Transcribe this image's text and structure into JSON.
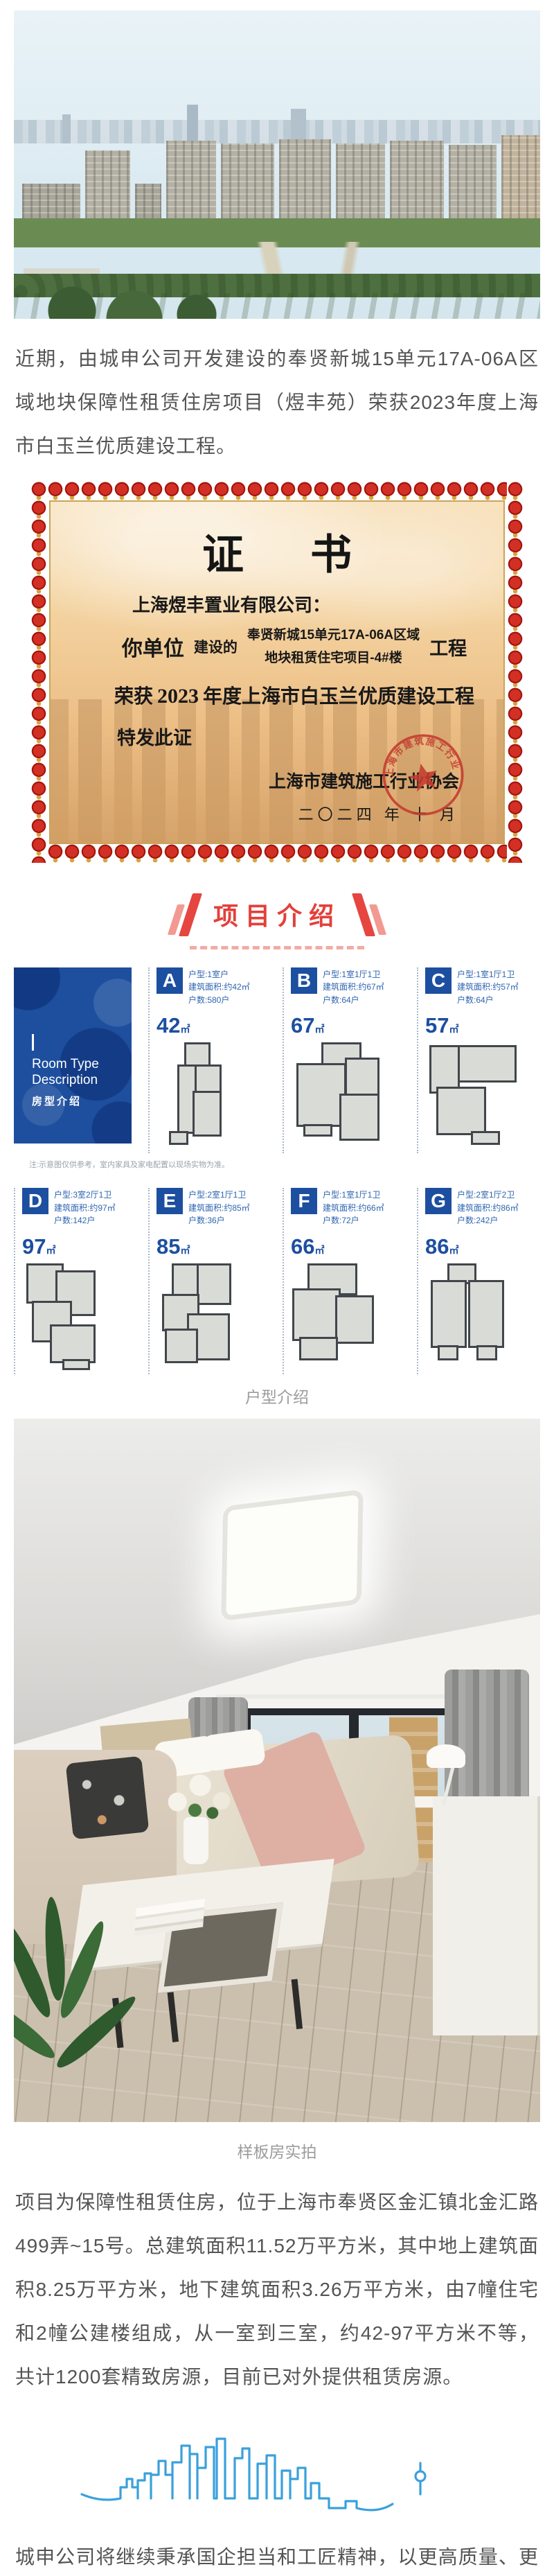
{
  "colors": {
    "accent_red": "#e3403a",
    "badge_blue": "#1d4fa0",
    "skyline_blue": "#3aa0dc",
    "seal_red": "#c43b2e"
  },
  "article": {
    "para1": "近期，由城申公司开发建设的奉贤新城15单元17A-06A区域地块保障性租赁住房项目（煜丰苑）荣获2023年度上海市白玉兰优质建设工程。",
    "para2": "项目为保障性租赁住房，位于上海市奉贤区金汇镇北金汇路499弄~15号。总建筑面积11.52万平方米，其中地上建筑面积8.25万平方米，地下建筑面积3.26万平方米，由7幢住宅和2幢公建楼组成，从一室到三室，约42-97平方米不等，共计1200套精致房源，目前已对外提供租赁房源。",
    "para3": "城申公司将继续秉承国企担当和工匠精神，以更高质量、更高标准、更高水平打造更多优质工程，助力绘制奉贤高质量发展新蓝图。"
  },
  "certificate": {
    "title": "证书",
    "recipient": "上海煜丰置业有限公司：",
    "you": "你单位",
    "built": "建设的",
    "project_line1": "奉贤新城15单元17A-06A区域",
    "project_line2": "地块租赁住宅项目-4#楼",
    "suffix": "工程",
    "award_prefix": "荣获",
    "award_year": "2023",
    "award_suffix": "年度上海市白玉兰优质建设工程",
    "issue": "特发此证",
    "issuer": "上海市建筑施工行业协会",
    "date": "二〇二四 年 十 月"
  },
  "section": {
    "title": "项目介绍"
  },
  "floorplans": {
    "cover": {
      "en1": "Room Type",
      "en2": "Description",
      "cn": "房型介绍"
    },
    "note": "注:示意图仅供参考，室内家具及家电配置以现场实物为准。",
    "sqm": "㎡",
    "units": [
      {
        "letter": "A",
        "type": "户型:1室户",
        "area": "建筑面积:约42㎡",
        "count": "户数:580户",
        "size": "42"
      },
      {
        "letter": "B",
        "type": "户型:1室1厅1卫",
        "area": "建筑面积:约67㎡",
        "count": "户数:64户",
        "size": "67"
      },
      {
        "letter": "C",
        "type": "户型:1室1厅1卫",
        "area": "建筑面积:约57㎡",
        "count": "户数:64户",
        "size": "57"
      },
      {
        "letter": "D",
        "type": "户型:3室2厅1卫",
        "area": "建筑面积:约97㎡",
        "count": "户数:142户",
        "size": "97"
      },
      {
        "letter": "E",
        "type": "户型:2室1厅1卫",
        "area": "建筑面积:约85㎡",
        "count": "户数:36户",
        "size": "85"
      },
      {
        "letter": "F",
        "type": "户型:1室1厅1卫",
        "area": "建筑面积:约66㎡",
        "count": "户数:72户",
        "size": "66"
      },
      {
        "letter": "G",
        "type": "户型:2室1厅2卫",
        "area": "建筑面积:约86㎡",
        "count": "户数:242户",
        "size": "86"
      }
    ]
  },
  "captions": {
    "floorplan": "户型介绍",
    "showroom": "样板房实拍"
  }
}
